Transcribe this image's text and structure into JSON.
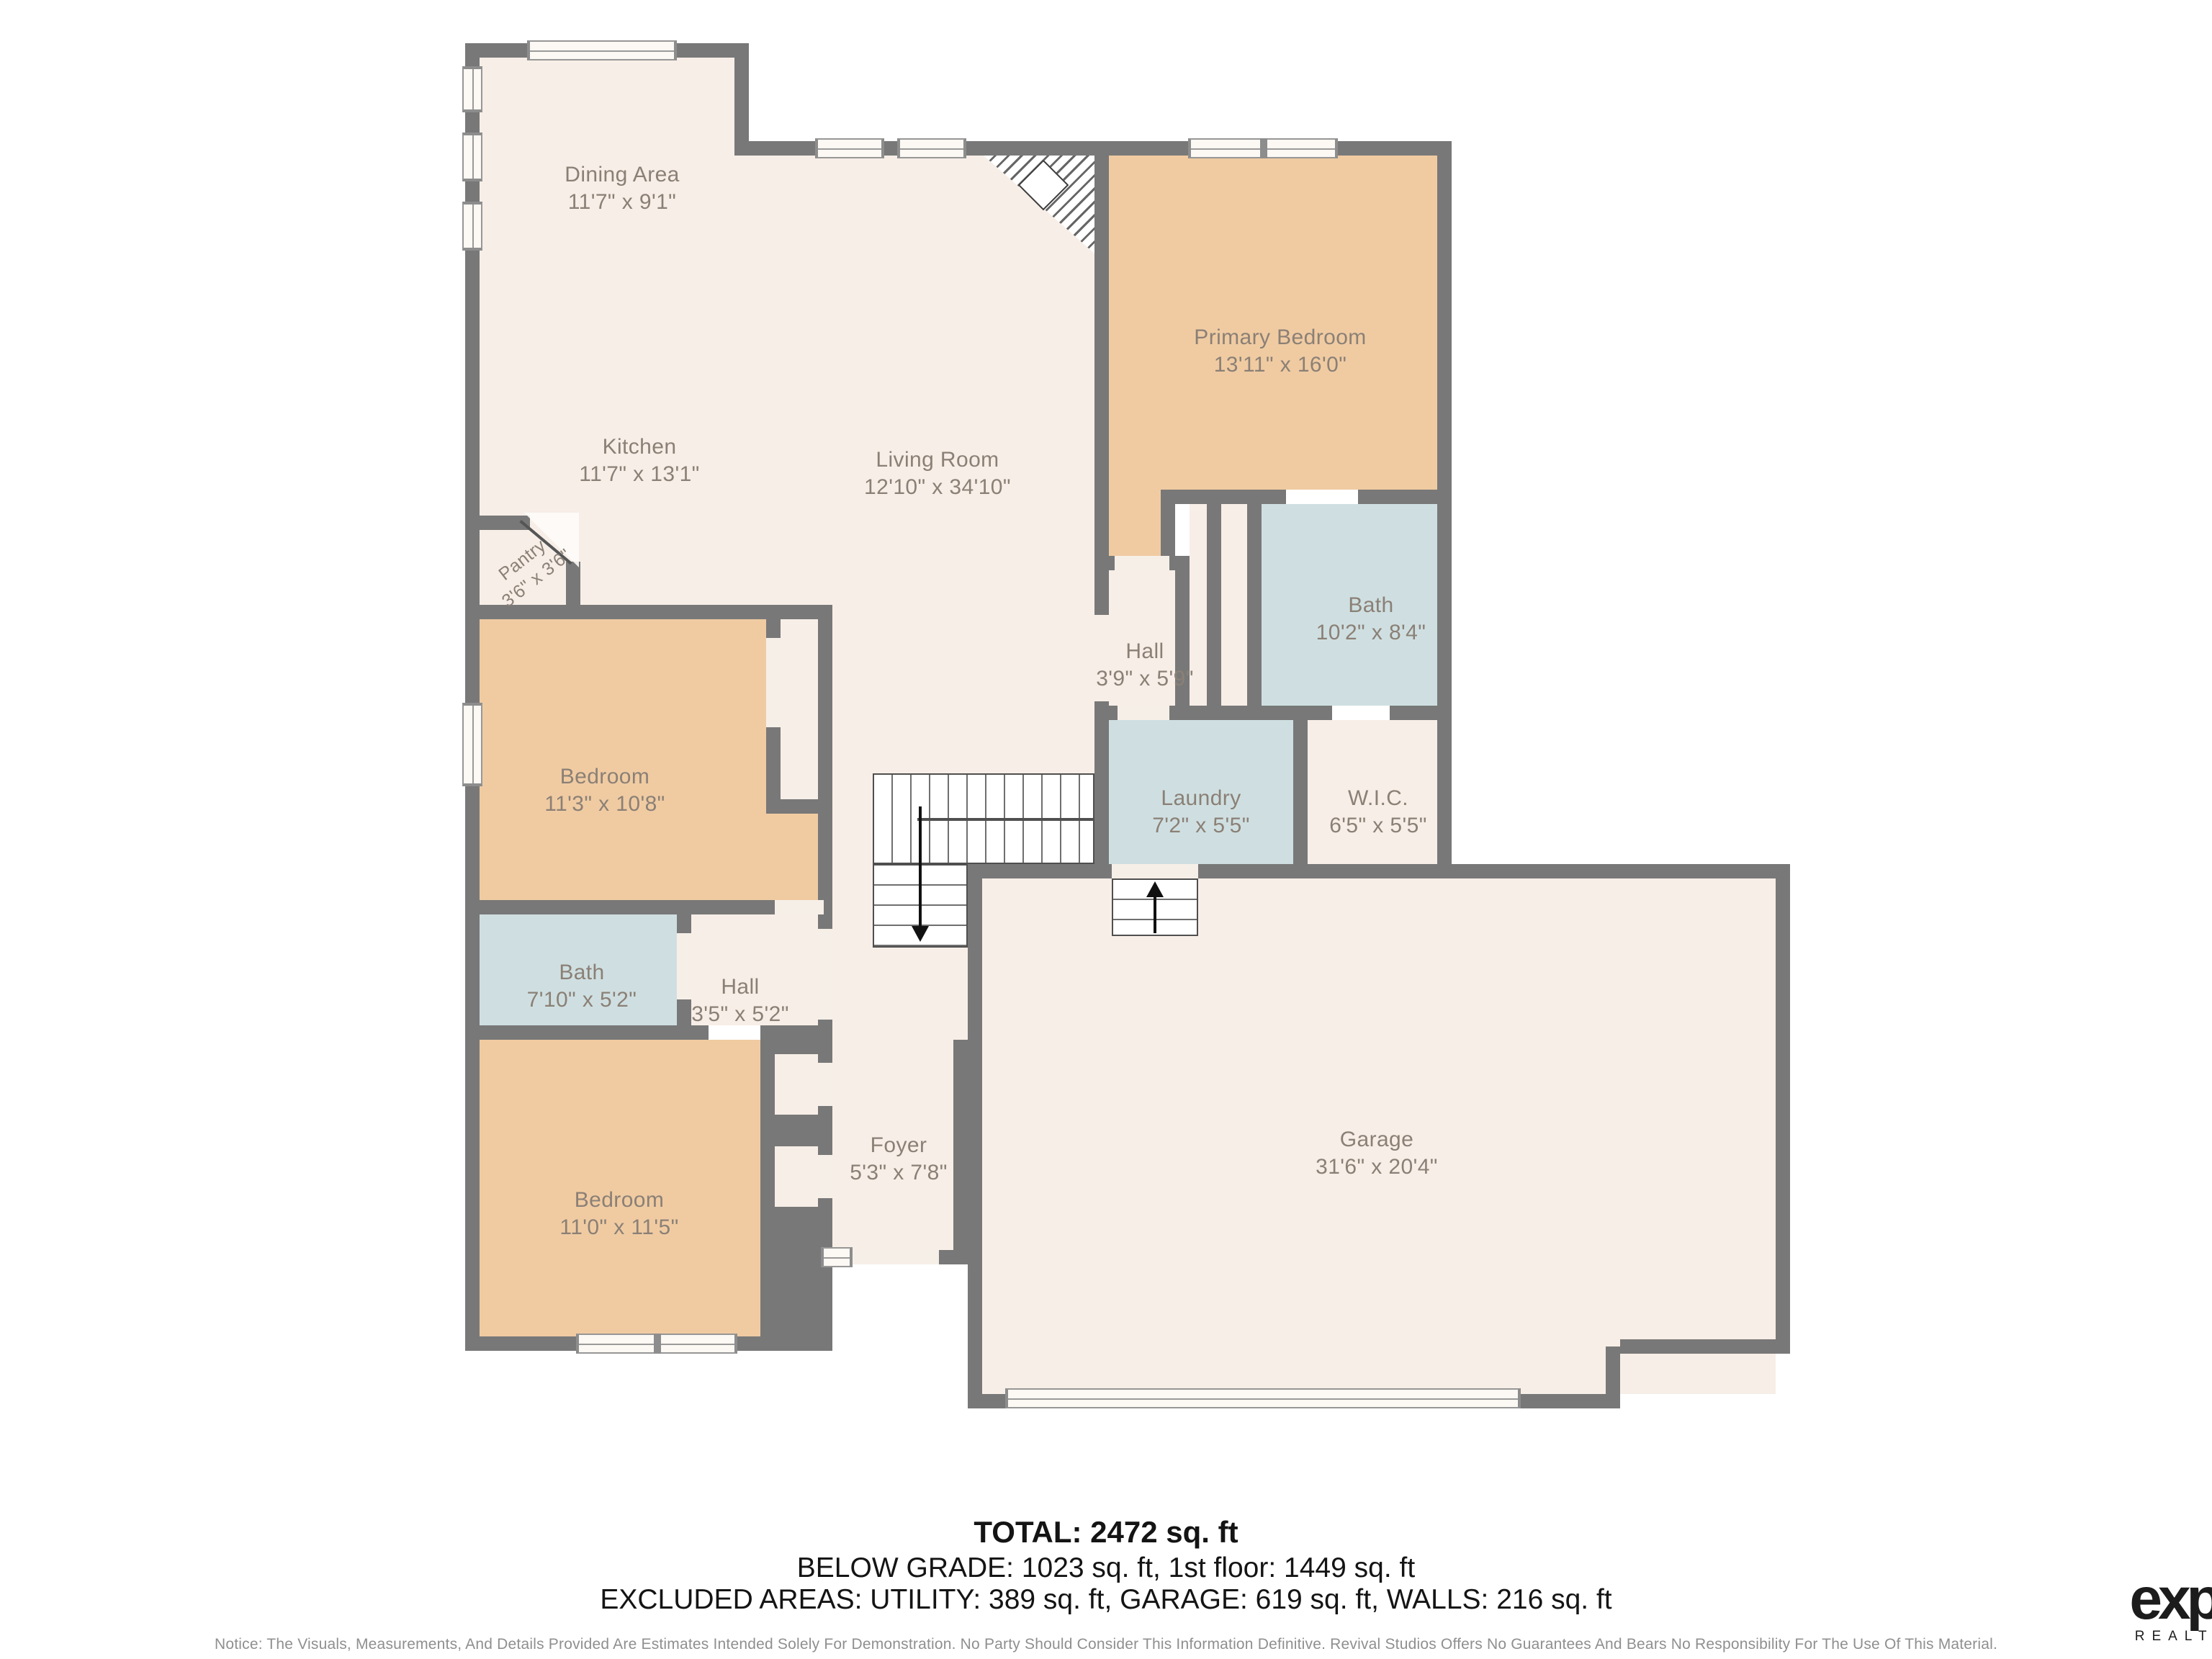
{
  "plan": {
    "rooms": [
      {
        "id": "dining",
        "name": "Dining Area",
        "dims": "11'7\" x 9'1\""
      },
      {
        "id": "kitchen",
        "name": "Kitchen",
        "dims": "11'7\" x 13'1\""
      },
      {
        "id": "living",
        "name": "Living Room",
        "dims": "12'10\" x 34'10\""
      },
      {
        "id": "primary-bedroom",
        "name": "Primary Bedroom",
        "dims": "13'11\" x 16'0\""
      },
      {
        "id": "pantry",
        "name": "Pantry",
        "dims": "3'6\" x 3'6\""
      },
      {
        "id": "bedroom-upper",
        "name": "Bedroom",
        "dims": "11'3\" x 10'8\""
      },
      {
        "id": "primary-bath",
        "name": "Bath",
        "dims": "10'2\" x 8'4\""
      },
      {
        "id": "hall-upper",
        "name": "Hall",
        "dims": "3'9\" x 5'9\""
      },
      {
        "id": "laundry",
        "name": "Laundry",
        "dims": "7'2\" x 5'5\""
      },
      {
        "id": "wic",
        "name": "W.I.C.",
        "dims": "6'5\" x 5'5\""
      },
      {
        "id": "bath-lower",
        "name": "Bath",
        "dims": "7'10\" x 5'2\""
      },
      {
        "id": "hall-lower",
        "name": "Hall",
        "dims": "3'5\" x 5'2\""
      },
      {
        "id": "bedroom-lower",
        "name": "Bedroom",
        "dims": "11'0\" x 11'5\""
      },
      {
        "id": "foyer",
        "name": "Foyer",
        "dims": "5'3\" x 7'8\""
      },
      {
        "id": "garage",
        "name": "Garage",
        "dims": "31'6\" x 20'4\""
      }
    ],
    "icons": [
      "stairs-down-arrow",
      "stairs-up-arrow",
      "corner-fireplace",
      "pantry-door-swing"
    ],
    "colors": {
      "wall": "#787878",
      "floor": "#f7eee7",
      "bedroom_floor": "#f0cba2",
      "wet_room_floor": "#cfdfe1",
      "label_text": "#8b8076",
      "logo_text": "#1c1c1c"
    }
  },
  "summary": {
    "total": "TOTAL: 2472 sq. ft",
    "grade_line": "BELOW GRADE: 1023 sq. ft, 1st floor: 1449 sq. ft",
    "excluded_line": "EXCLUDED AREAS: UTILITY: 389 sq. ft, GARAGE: 619 sq. ft, WALLS: 216 sq. ft"
  },
  "notice": "Notice: The Visuals, Measurements, And Details Provided Are Estimates Intended Solely For Demonstration. No Party Should Consider This Information Definitive. Revival Studios Offers No Guarantees And Bears No Responsibility For The Use Of This Material.",
  "brand": {
    "name": "exp",
    "trademark": "™",
    "subtitle": "REALTY"
  }
}
